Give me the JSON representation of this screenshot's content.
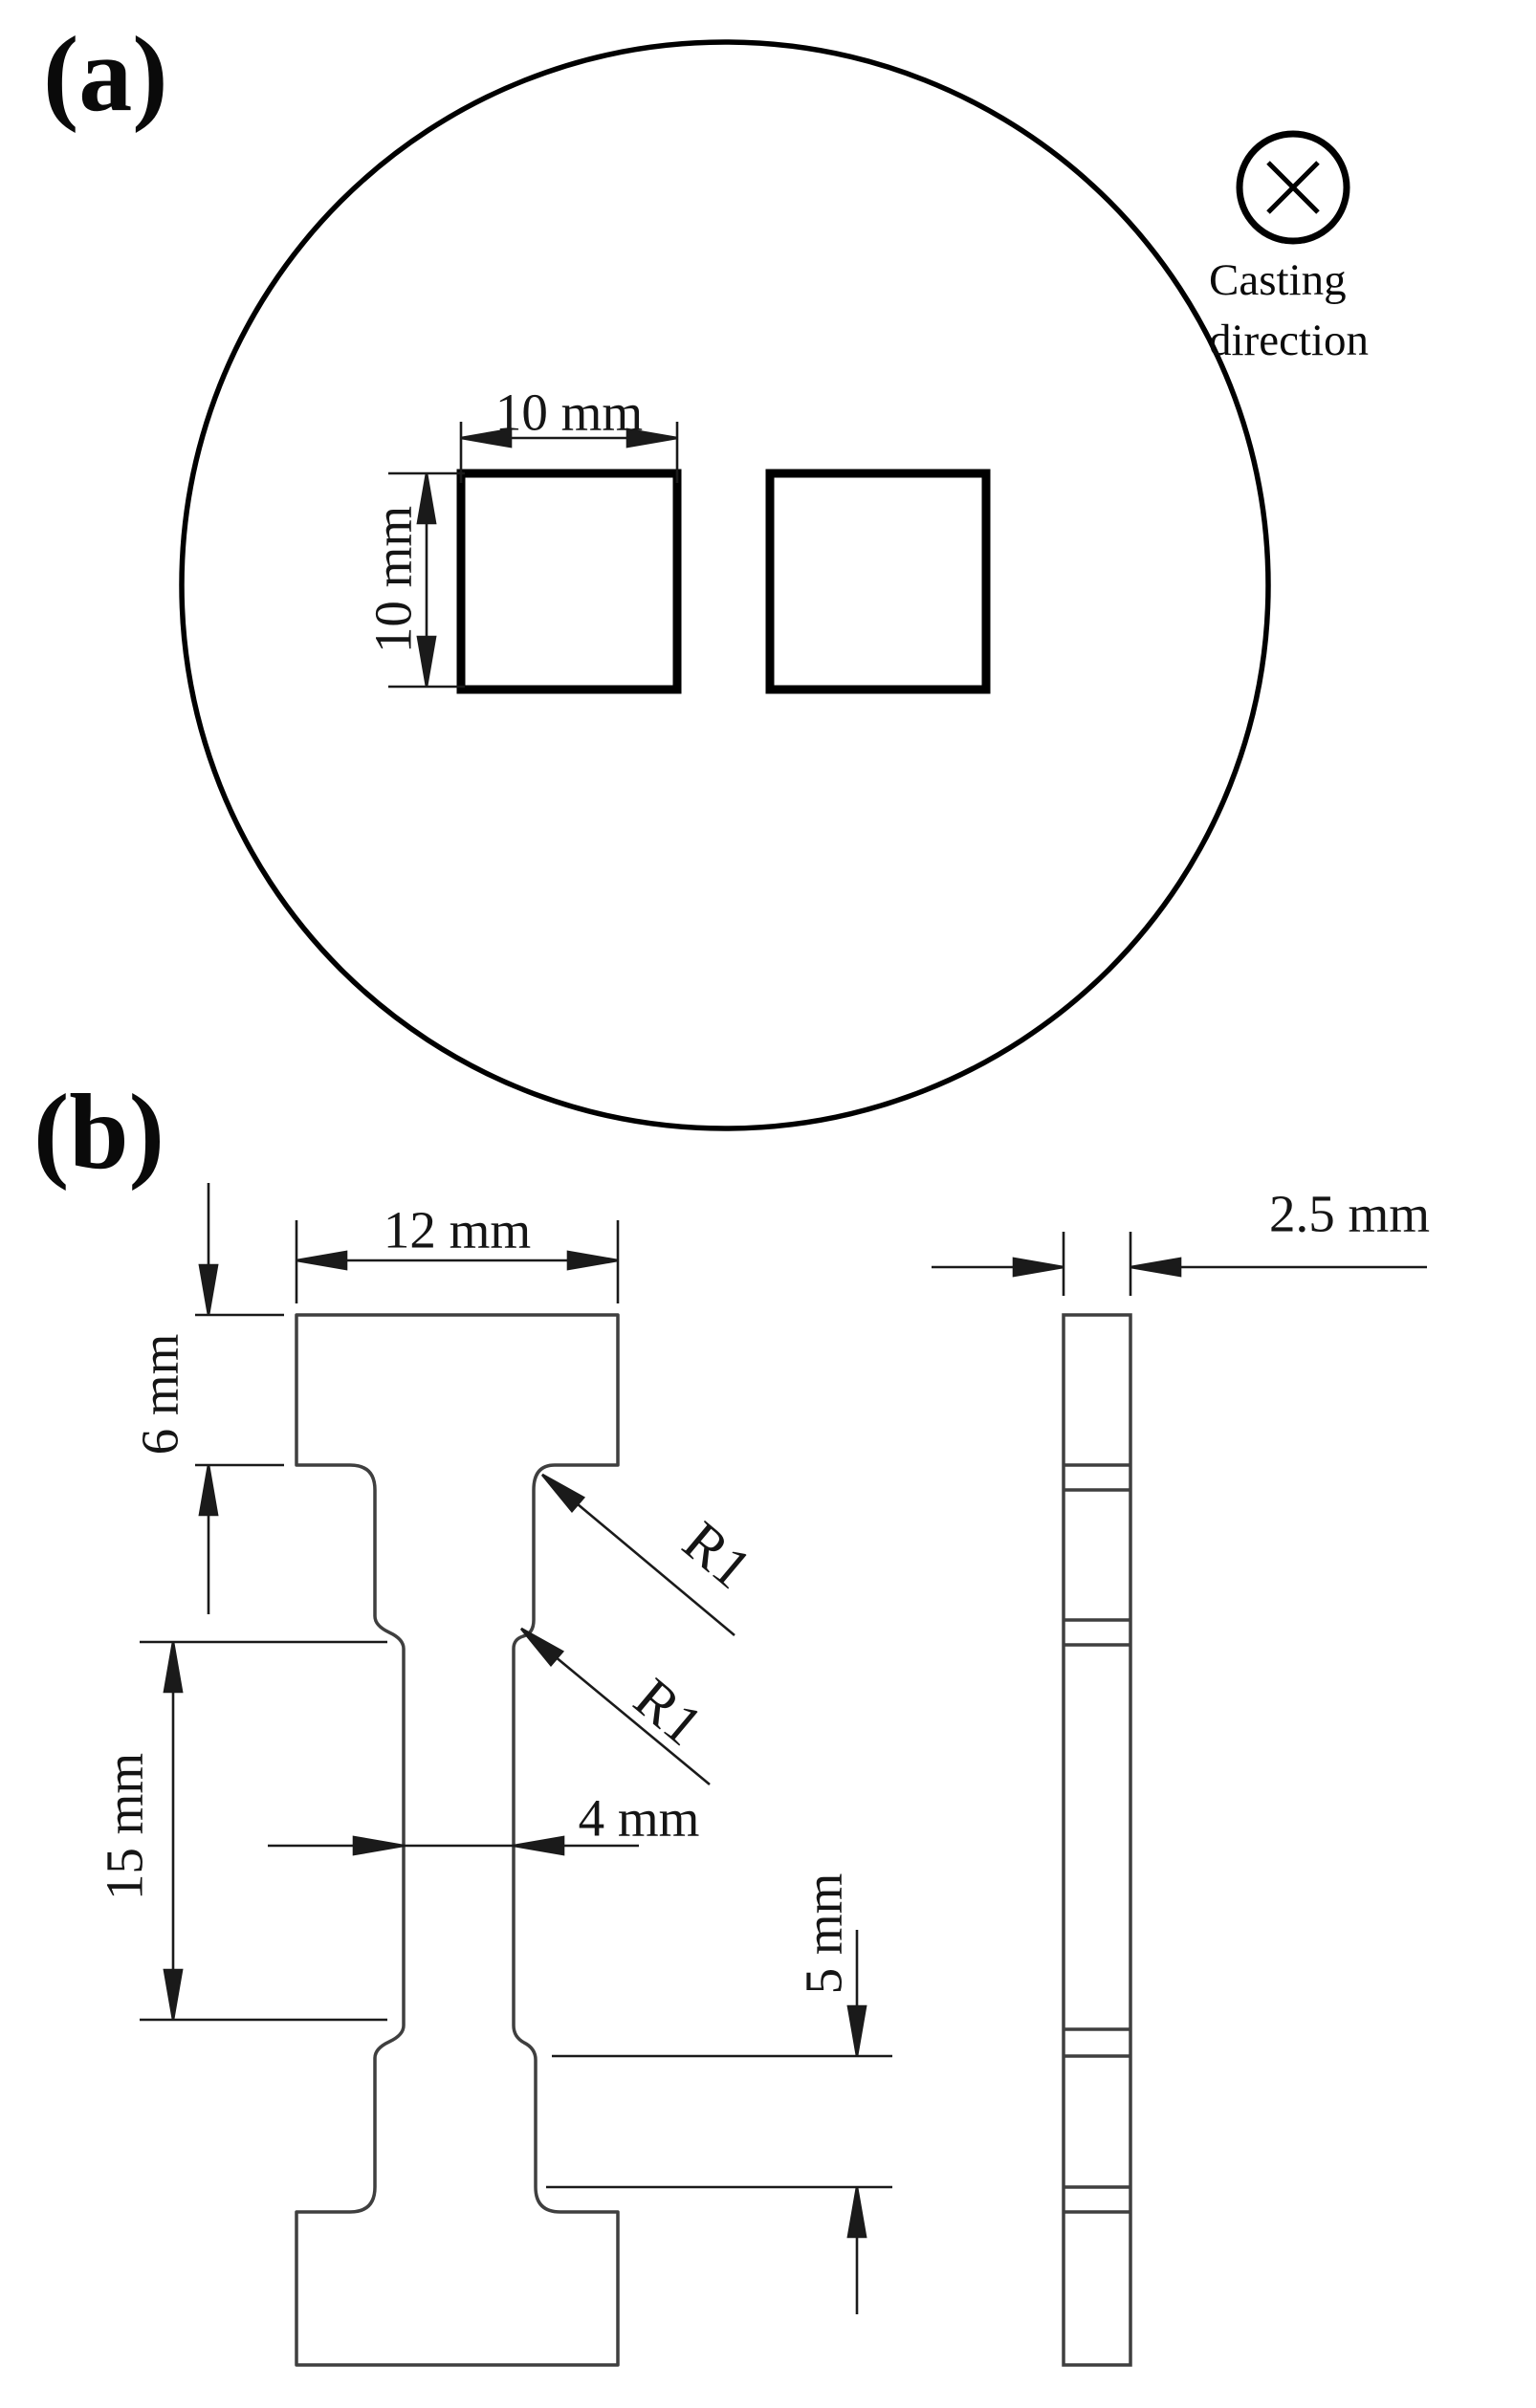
{
  "panel_a": {
    "label": "(a)",
    "square_width_dim": "10 mm",
    "square_height_dim": "10 mm",
    "casting_direction_line1": "Casting",
    "casting_direction_line2": "direction"
  },
  "panel_b": {
    "label": "(b)",
    "grip_width_dim": "12 mm",
    "grip_height_dim": "6 mm",
    "gauge_length_dim": "15 mm",
    "gauge_width_dim": "4 mm",
    "shoulder_offset_dim": "5 mm",
    "thickness_dim": "2.5 mm",
    "fillet_radius_upper": "R1",
    "fillet_radius_lower": "R1"
  },
  "colors": {
    "ink": "#000000",
    "outline": "#3f3f3f",
    "dimension": "#1a1a1a"
  }
}
